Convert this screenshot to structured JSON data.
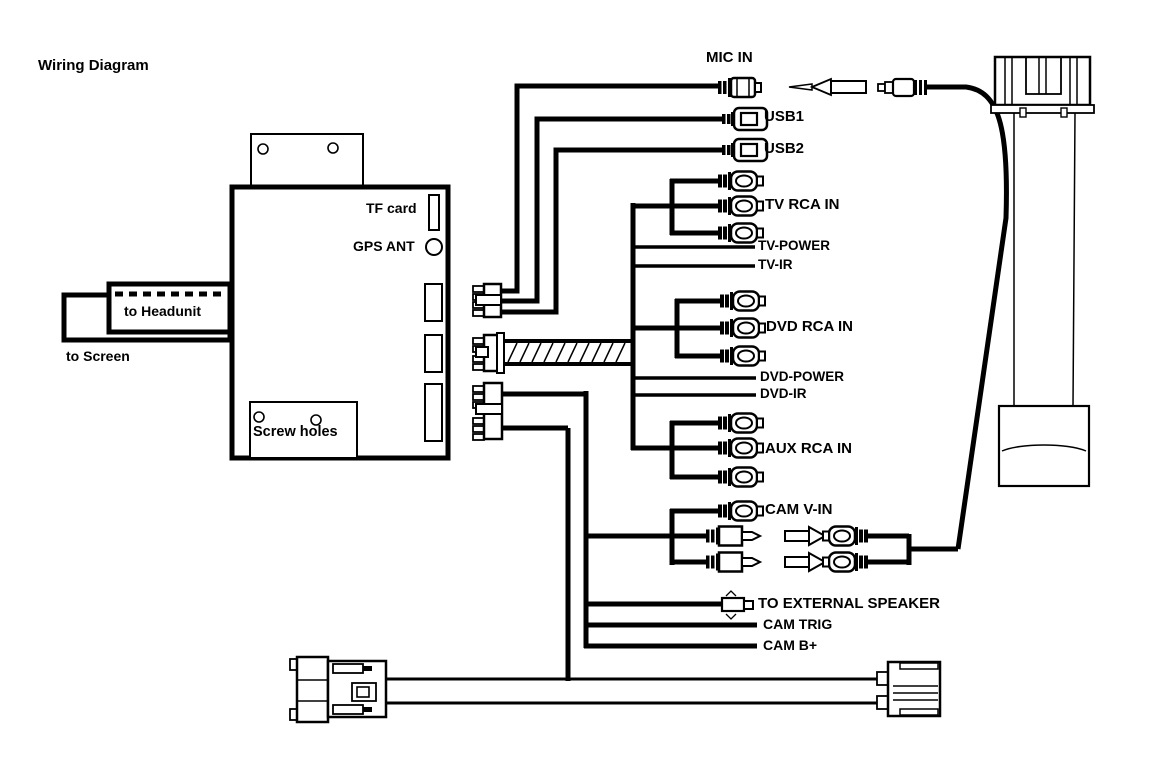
{
  "title": "Wiring Diagram",
  "colors": {
    "ink": "#000000",
    "background": "#ffffff"
  },
  "unit": {
    "tf_card": "TF card",
    "gps_ant": "GPS ANT",
    "screw_holes": "Screw holes"
  },
  "cables": {
    "to_headunit": "to Headunit",
    "to_screen": "to Screen"
  },
  "connections": {
    "mic_in": "MIC IN",
    "usb1": "USB1",
    "usb2": "USB2",
    "tv_rca_in": "TV RCA IN",
    "tv_power": "TV-POWER",
    "tv_ir": "TV-IR",
    "dvd_rca_in": "DVD RCA IN",
    "dvd_power": "DVD-POWER",
    "dvd_ir": "DVD-IR",
    "aux_rca_in": "AUX RCA IN",
    "cam_v_in": "CAM V-IN",
    "to_external_speaker": "TO EXTERNAL SPEAKER",
    "cam_trig": "CAM TRIG",
    "cam_b_plus": "CAM B+"
  }
}
